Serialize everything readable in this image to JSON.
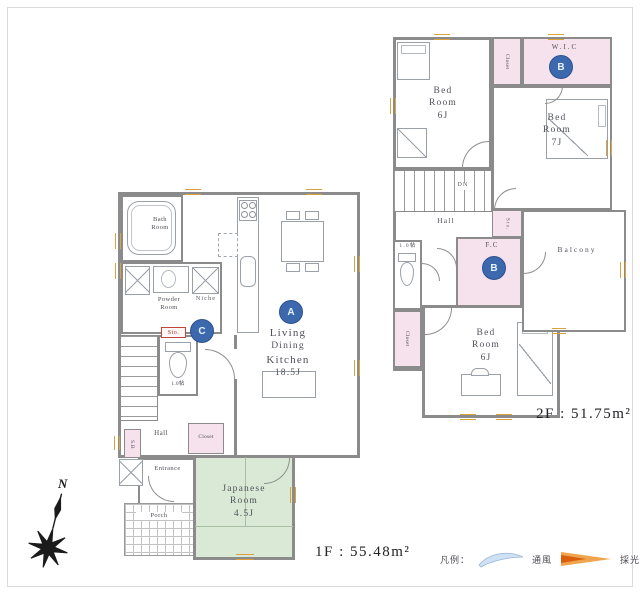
{
  "page": {
    "floor1_area": "1F : 55.48m²",
    "floor2_area": "2F : 51.75m²"
  },
  "compass": {
    "north": "N"
  },
  "legend": {
    "title": "凡例：",
    "wind_label": "通風",
    "light_label": "採光"
  },
  "palette": {
    "marker_blue": "#3c69ad",
    "closet_pink": "#f6e2ec",
    "tatami_green": "#d9e9d5",
    "window_orange": "#d9a23e",
    "wind_arrow_blue": "#cfe2f4",
    "light_arrow_orange": "#d95f0e"
  },
  "floor1": {
    "bath": {
      "lines": [
        "Bath",
        "Room"
      ]
    },
    "powder": {
      "lines": [
        "Powder",
        "Room"
      ]
    },
    "niche": "Niche",
    "storage": "Sto.",
    "toilet_size": "1.0帖",
    "hall": "Hall",
    "closet": "Closet",
    "shoe_box": "S.B",
    "entrance": "Entrance",
    "porch": "Porch",
    "ldk": {
      "lines": [
        "Living",
        "Dining",
        "Kitchen"
      ],
      "size": "18.5J"
    },
    "japanese_room": {
      "lines": [
        "Japanese",
        "Room"
      ],
      "size": "4.5J"
    },
    "markers": {
      "a": "A",
      "c": "C"
    }
  },
  "floor2": {
    "bedroom_nw": {
      "lines": [
        "Bed",
        "Room"
      ],
      "size": "6J"
    },
    "bedroom_e": {
      "lines": [
        "Bed",
        "Room"
      ],
      "size": "7J"
    },
    "bedroom_s": {
      "lines": [
        "Bed",
        "Room"
      ],
      "size": "6J"
    },
    "closet_top": "Closet",
    "wic": "W.I.C",
    "family_closet": "F.C",
    "storage": "Sto.",
    "closet_left": "Closet",
    "toilet_size": "1.0帖",
    "hall": "Hall",
    "balcony": "Balcony",
    "stairs_dn": "DN",
    "markers": {
      "b1": "B",
      "b2": "B"
    }
  }
}
